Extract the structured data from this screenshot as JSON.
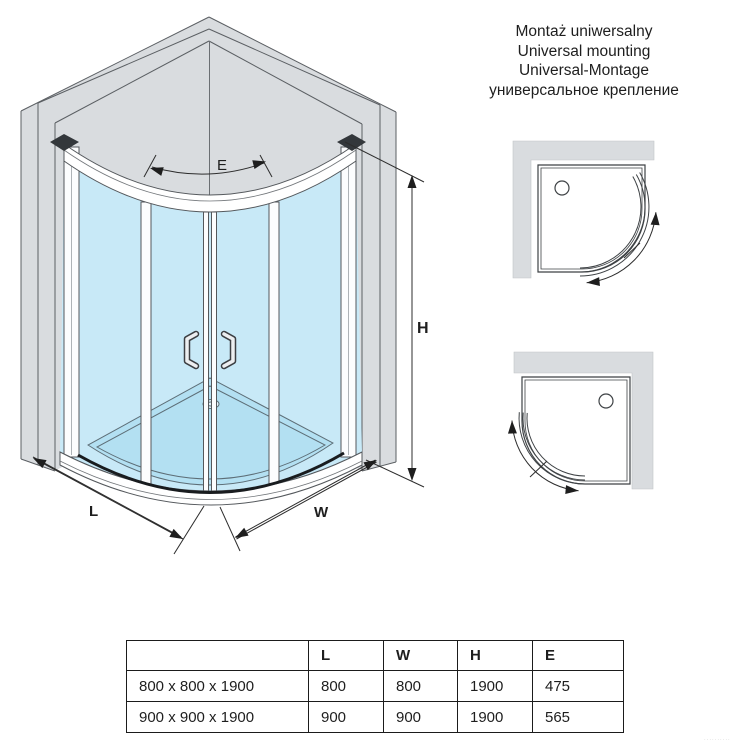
{
  "title_block": {
    "line1": "Montaż uniwersalny",
    "line2": "Universal mounting",
    "line3": "Universal-Montage",
    "line4": "универсальное крепление"
  },
  "dimensions": {
    "e": "E",
    "h": "H",
    "l": "L",
    "w": "W"
  },
  "spec_table": {
    "col_headers": {
      "label": "",
      "l": "L",
      "w": "W",
      "h": "H",
      "e": "E"
    },
    "rows": [
      {
        "label": "800 x 800 x 1900",
        "l": "800",
        "w": "800",
        "h": "1900",
        "e": "475"
      },
      {
        "label": "900 x 900 x 1900",
        "l": "900",
        "w": "900",
        "h": "1900",
        "e": "565"
      }
    ]
  },
  "colors": {
    "wall_gray": "#d9dcdf",
    "glass_blue": "#c8e9f7",
    "tray_blue": "#b3e0f2",
    "line_dark": "#54585c",
    "dimension_black": "#2d2d2d"
  },
  "watermark": "··········"
}
